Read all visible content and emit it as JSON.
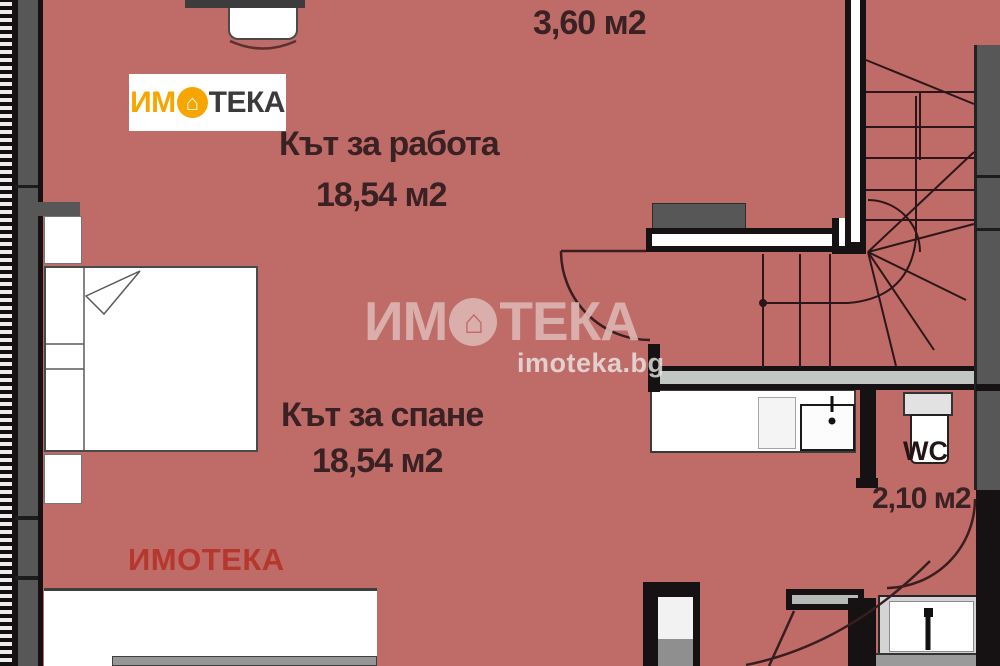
{
  "plan": {
    "labels": {
      "bath_top_area": "3,60 м2",
      "work_name": "Кът за работа",
      "work_area": "18,54 м2",
      "sleep_name": "Кът за спане",
      "sleep_area": "18,54 м2",
      "wc_name": "WC",
      "wc_area": "2,10 м2"
    }
  },
  "branding": {
    "logo_im": "ИМ",
    "logo_teka": "ТЕКА",
    "house_glyph": "⌂",
    "watermark_im": "ИМ",
    "watermark_teka": "ТЕКА",
    "watermark_site": "imoteka.bg",
    "watermark_red": "ИМОТЕКА"
  },
  "colors": {
    "floor": "#bf6b67",
    "wall_dark": "#161213",
    "wall_gray": "#575757",
    "wall_light": "#c3c7c3",
    "label_text": "#3a2224",
    "logo_orange": "#f7a600",
    "logo_dark": "#3b3b3b",
    "brand_red": "#b5372e"
  }
}
